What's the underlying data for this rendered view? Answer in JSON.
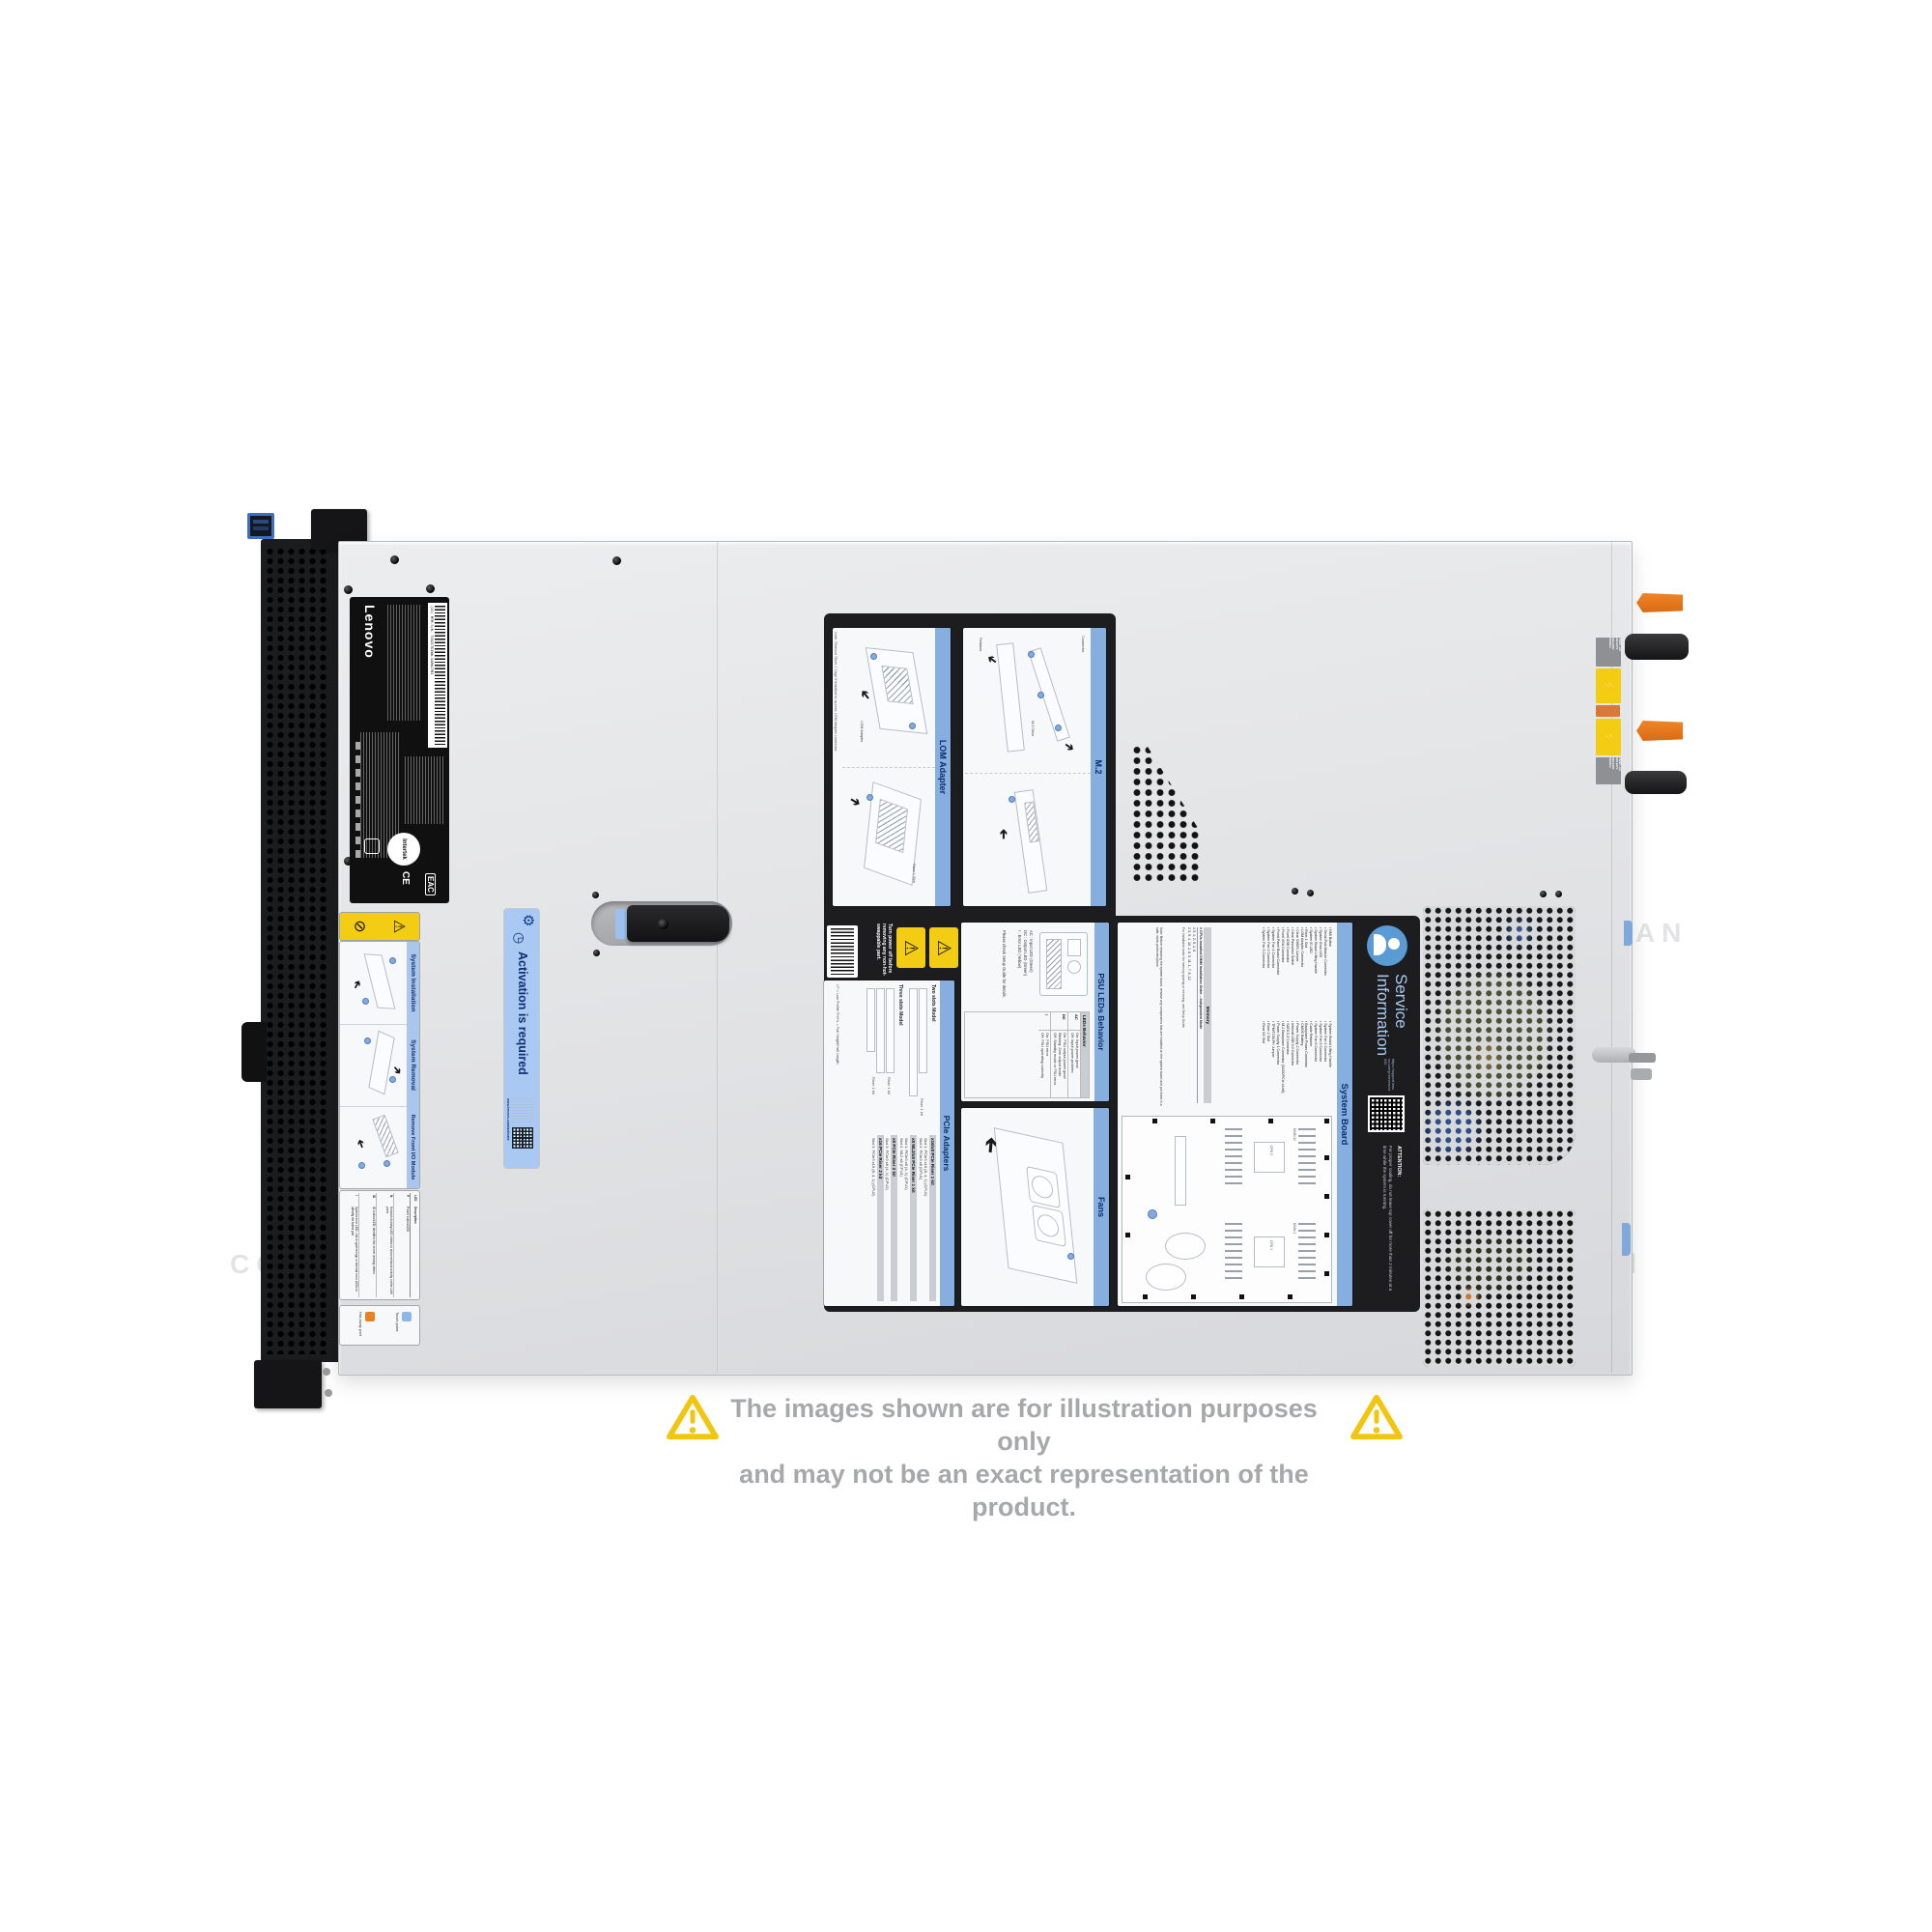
{
  "watermark": {
    "text": "COMPAN"
  },
  "icons": {
    "arrow": "➔",
    "warning": "⚠",
    "prohibited": "⊘",
    "gear": "⚙",
    "clock": "◷",
    "bolt": "⚡"
  },
  "disclaimer": {
    "line1": "The images shown are for illustration purposes only",
    "line2": "and may not be an exact representation of the product."
  },
  "labels": {
    "lenovo": {
      "brand": "Lenovo",
      "barcode_text": "(1S) MTM-S/N: 7X02CTO1WW-SA8WJ7B3",
      "cert": "Intertek",
      "ce": "CE",
      "eac": "EAC"
    },
    "activation": {
      "title": "Activation is required",
      "url": "www.lenovo.com/activate"
    },
    "front_sections": [
      {
        "title": "System Installation"
      },
      {
        "title": "System Removal"
      },
      {
        "title": "Remove Front I/O Module"
      }
    ],
    "led_table": {
      "col1": "LED",
      "col2": "Description",
      "rows": [
        {
          "k": "P",
          "v": "Power button/LED"
        },
        {
          "k": "N",
          "v": "Network Activity LED: blinks to show network activity on the LAN ports"
        },
        {
          "k": "ID",
          "v": "ID button/LED: identifies the server among others"
        },
        {
          "k": "!",
          "v": "System error LED: check system logs or internal error LEDs to identify the failed part"
        }
      ]
    },
    "legend": [
      {
        "label": "Touch point"
      },
      {
        "label": "Hot-swap port"
      }
    ]
  },
  "panel": {
    "lom": {
      "title": "LOM Adapter",
      "note": "Note: Remove Riser 1 Cage if installed to access LOM Adapter connector.",
      "label1": "LOM Adapter",
      "label2": "Riser 1 Slot"
    },
    "m2": {
      "title": "M.2",
      "label1": "Connector",
      "label2": "M.2 Drive",
      "label3": "Retainer"
    },
    "power_warning": "Turn power off before removing any non-hot-swappable part.",
    "pcie": {
      "title": "PCIe Adapters",
      "model1": "Two slots Model",
      "model2": "Three slots Model",
      "riser1": "Riser 1 kit",
      "riser2": "Riser 2 kit",
      "legend": "LP = Low Profile    FH/HL = Full Height/Half Length",
      "kits": [
        {
          "name": "x16/x8 PCIe Riser 1 kit",
          "slots": "Slot 1: PCIe3 x16 (8, 4, 1) (CPU1)\nSlot 2: PCIe3 x8 (CPU1)"
        },
        {
          "name": "x8 ML2/x8 PCIe Riser 1 kit",
          "slots": "Slot 1: PCIe3 x8 (4, 1) (CPU1)\nSlot 2: ML2 x8 (CPU1)"
        },
        {
          "name": "x8 PCIe Riser 2 kit",
          "slots": "Slot 3: PCIe3 x8 (4, 1) (CPU2)"
        },
        {
          "name": "x16 PCIe Riser 2 kit",
          "slots": "Slot 3: PCIe3 x16 (8, 4, 1) (CPU2)"
        }
      ]
    },
    "psu": {
      "title": "PSU LEDs Behavior",
      "callouts": "AC : Input LED (Green)\nDC : Output LED (Green)\n!  : Error LED (Yellow)",
      "note": "Please check Setup Guide for details.",
      "table_title": "LEDs Behavior",
      "rows": [
        {
          "key": "AC",
          "val": "On: Input power good\nOff: Input power problem"
        },
        {
          "key": "DC",
          "val": "On: PSU output power good\nBlinking: Zero output mode\nOff: Standby mode or PSU error"
        },
        {
          "key": "!",
          "val": "On: PSU error\nOff: PSU operating correctly"
        }
      ]
    },
    "fans": {
      "title": "Fans"
    },
    "sb": {
      "title": "System Board",
      "col1": "▪ NMI Button\n▪ Serial-Port-Module Connector\n▪ System Error LED\n▪ System Board Lifting Handle\n▪ System ID LED\n▪ Riser 1 Slot\n▪ LOM Adapter Connector\n▪ Clear CMOS Jumper\n▪ Clear Password Switch\n▪ Front USB Connector\n▪ Front VGA Connector\n▪ Front-Panel Board Connector\n▪ System Fan 1 Connector\n▪ System Fan 2 Connector\n▪ System Fan 3 Connector",
      "col2": "▪ System Board Lifting Handle\n▪ System Fan 4 Connector\n▪ System Fan 5 Connector\n▪ System Fan 6 Connector\n▪ Cable Retainer\n▪ Backplane Power Connector\n▪ CMOS Battery\n▪ Power Supply 2 Connector\n▪ Internal USB 3.0 Connector\n▪ SATA 0-3 Connector\n▪ M.2 Backplane Connector (SATA/PCIe x4/x8)\n▪ Power Supply 1 Connector\n▪ TPM/TCM-PH Jumper\n▪ Riser 2 Slot\n▪ Rear I/O Slot",
      "memory_title": "Memory",
      "memory_header": "# CPUs Installed     DIMM Installation Order – Independent Mode",
      "memory_rows": "1          3, 4, 2, 5, 1, 6\n2          3, 9, 4, 10, 2, 8, 5, 11, 1, 7, 6, 12",
      "memory_note": "For installation order for memory sparing or mirroring, see Setup Guide.",
      "note": "Note: Before removing the system board, remove any components that are installed on the system board and put them in a safe, static-protected place.",
      "dimm_a": "DIMM 12",
      "dimm_b": "DIMM 1",
      "cpu1": "CPU 1",
      "cpu2": "CPU 2"
    },
    "service": {
      "title_line1": "Service",
      "title_line2": "Information",
      "url": "https://support.lenovo.com/p/servers/sr630",
      "attention_title": "ATTENTION:",
      "attention_body": "For proper cooling, do not leave top cover off for more than 2 minutes at a time while the system is running."
    }
  },
  "rear": {
    "psu_spec": "750W ~AC\n100-127V\n200-240V\n50/60Hz"
  }
}
